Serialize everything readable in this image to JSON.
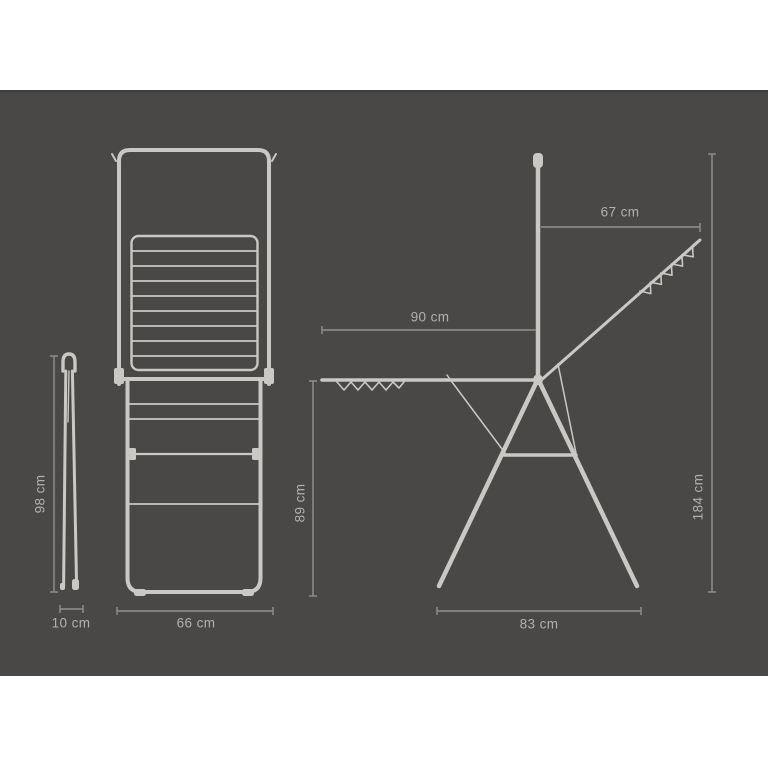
{
  "page": {
    "background": "#ffffff",
    "panel_color": "#4a4846"
  },
  "diagram": {
    "type": "product-dimension-diagram",
    "subject": "folding clothes drying rack with hanging arm",
    "colors": {
      "product_line": "#c9c8c5",
      "dimension_line": "#93918d",
      "label_text": "#b2b0ad"
    },
    "labels": {
      "folded_height": "98 cm",
      "folded_depth": "10 cm",
      "front_width": "66 cm",
      "side_wing_span": "90 cm",
      "side_top_arm": "67 cm",
      "side_rack_height": "89 cm",
      "side_total_height": "184 cm",
      "side_base_width": "83 cm"
    }
  }
}
